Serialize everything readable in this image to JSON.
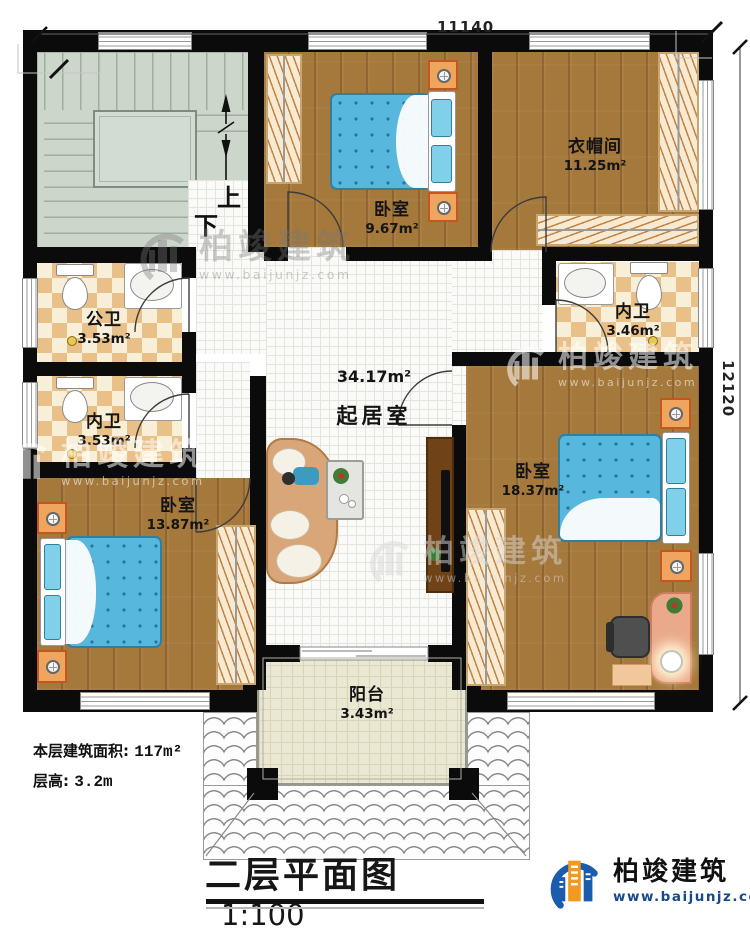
{
  "dimensions": {
    "top": "11140",
    "right": "12120"
  },
  "stairs": {
    "up": "上",
    "down": "下"
  },
  "rooms": [
    {
      "name": "衣帽间",
      "area": "11.25m²"
    },
    {
      "name": "卧室",
      "area": "9.67m²"
    },
    {
      "name": "公卫",
      "area": "3.53m²"
    },
    {
      "name": "内卫",
      "area": "3.46m²"
    },
    {
      "name": "内卫",
      "area": "3.53m²"
    },
    {
      "name": "起居室",
      "area": "34.17m²"
    },
    {
      "name": "卧室",
      "area": "13.87m²"
    },
    {
      "name": "卧室",
      "area": "18.37m²"
    },
    {
      "name": "阳台",
      "area": "3.43m²"
    }
  ],
  "footer": {
    "building_area_label": "本层建筑面积:",
    "building_area_value": "117m²",
    "floor_height_label": "层高:",
    "floor_height_value": "3.2m",
    "plan_title": "二层平面图",
    "plan_scale": "1:100"
  },
  "brand": {
    "name": "柏竣建筑",
    "website": "www.baijunjz.com"
  },
  "watermark": {
    "name": "柏竣建筑",
    "website": "www.baijunjz.com"
  },
  "colors": {
    "accent_blue": "#1b5cad",
    "accent_orange": "#f29a1f",
    "wall": "#0b0b0b",
    "wood": "#a5783b",
    "bed_blue": "#58b7dc"
  }
}
